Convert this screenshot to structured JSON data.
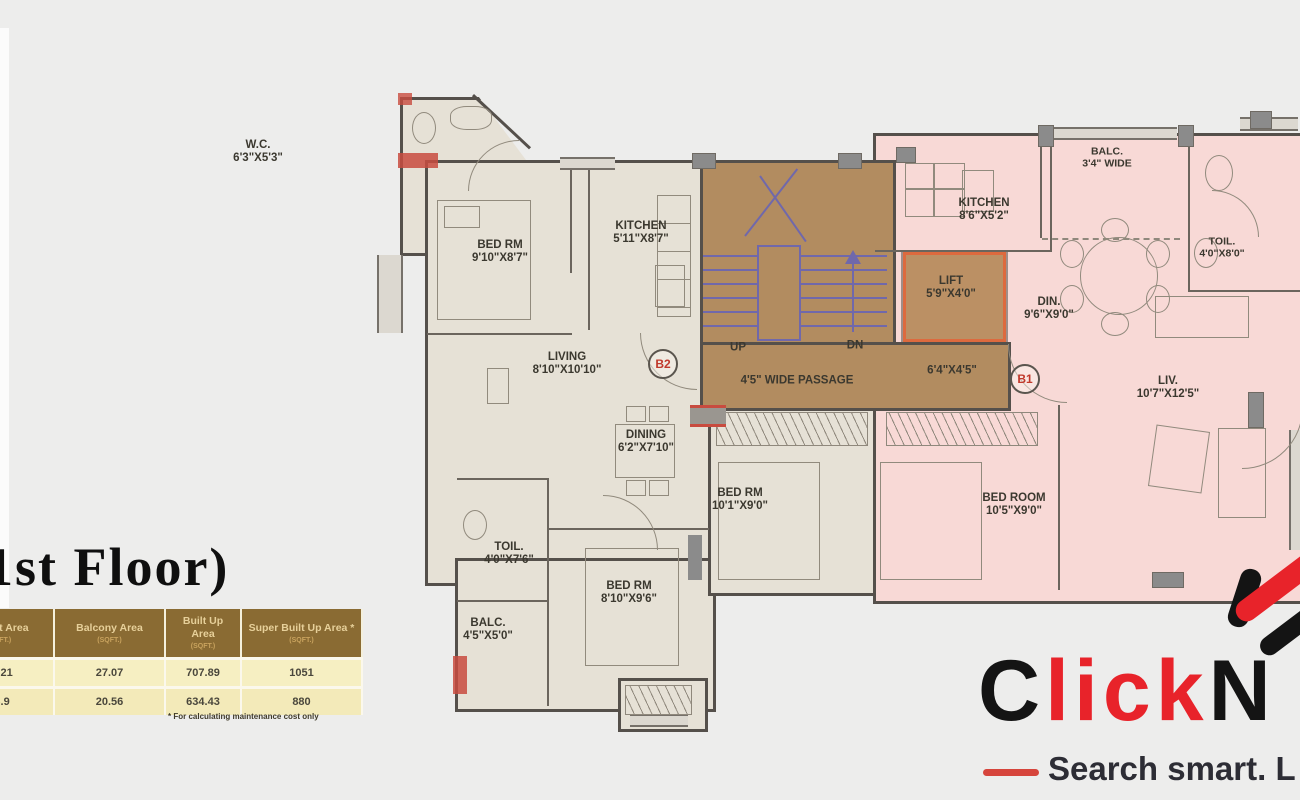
{
  "title": "(1st Floor)",
  "table": {
    "headers": [
      {
        "title": "Carpet Area",
        "sub": "(SQFT.)"
      },
      {
        "title": "Balcony Area",
        "sub": "(SQFT.)"
      },
      {
        "title": "Built Up Area",
        "sub": "(SQFT.)"
      },
      {
        "title": "Super Built Up Area *",
        "sub": "(SQFT.)"
      }
    ],
    "rows": [
      [
        "41.21",
        "27.07",
        "707.89",
        "1051"
      ],
      [
        "26.9",
        "20.56",
        "634.43",
        "880"
      ]
    ],
    "footnote": "* For calculating maintenance cost only"
  },
  "plan": {
    "rooms": {
      "wc": {
        "name": "W.C.",
        "dims": "6'3\"X5'3\""
      },
      "bed1": {
        "name": "BED RM",
        "dims": "9'10\"X8'7\""
      },
      "kitchen_b2": {
        "name": "KITCHEN",
        "dims": "5'11\"X8'7\""
      },
      "living": {
        "name": "LIVING",
        "dims": "8'10\"X10'10\""
      },
      "dining": {
        "name": "DINING",
        "dims": "6'2\"X7'10\""
      },
      "toil_b2": {
        "name": "TOIL.",
        "dims": "4'0\"X7'6\""
      },
      "balc_b2": {
        "name": "BALC.",
        "dims": "4'5\"X5'0\""
      },
      "bed2": {
        "name": "BED RM",
        "dims": "8'10\"X9'6\""
      },
      "bed3": {
        "name": "BED RM",
        "dims": "10'1\"X9'0\""
      },
      "kitchen_b1": {
        "name": "KITCHEN",
        "dims": "8'6\"X5'2\""
      },
      "balc_b1": {
        "name": "BALC.",
        "dims": "3'4\" WIDE"
      },
      "toil_b1": {
        "name": "TOIL.",
        "dims": "4'0\"X8'0\""
      },
      "din": {
        "name": "DIN.",
        "dims": "9'6\"X9'0\""
      },
      "liv": {
        "name": "LIV.",
        "dims": "10'7\"X12'5\""
      },
      "bed_b1": {
        "name": "BED ROOM",
        "dims": "10'5\"X9'0\""
      },
      "lift": {
        "name": "LIFT",
        "dims": "5'9\"X4'0\""
      },
      "lobby": {
        "dims": "6'4\"X4'5\""
      }
    },
    "stairs": {
      "up": "UP",
      "dn": "DN",
      "passage": "4'5\" WIDE PASSAGE"
    },
    "badges": {
      "b1": "B1",
      "b2": "B2"
    }
  },
  "logo": {
    "brand_part1": "C",
    "brand_part2": "lick",
    "brand_part3": "N",
    "tagline": "Search smart. L"
  },
  "colors": {
    "brand_red": "#e8232a",
    "brand_black": "#141414",
    "unit_b2_fill": "#e6e1d6",
    "unit_b1_fill": "#f8d9d6",
    "core_brown": "#b28c60",
    "lift_border": "#dd6a3e",
    "stair_line": "#7068ab",
    "wall": "#55504b",
    "table_header_bg": "#8a6b33",
    "table_row_bg": "#f6efc2",
    "badge_text": "#c0392b"
  }
}
